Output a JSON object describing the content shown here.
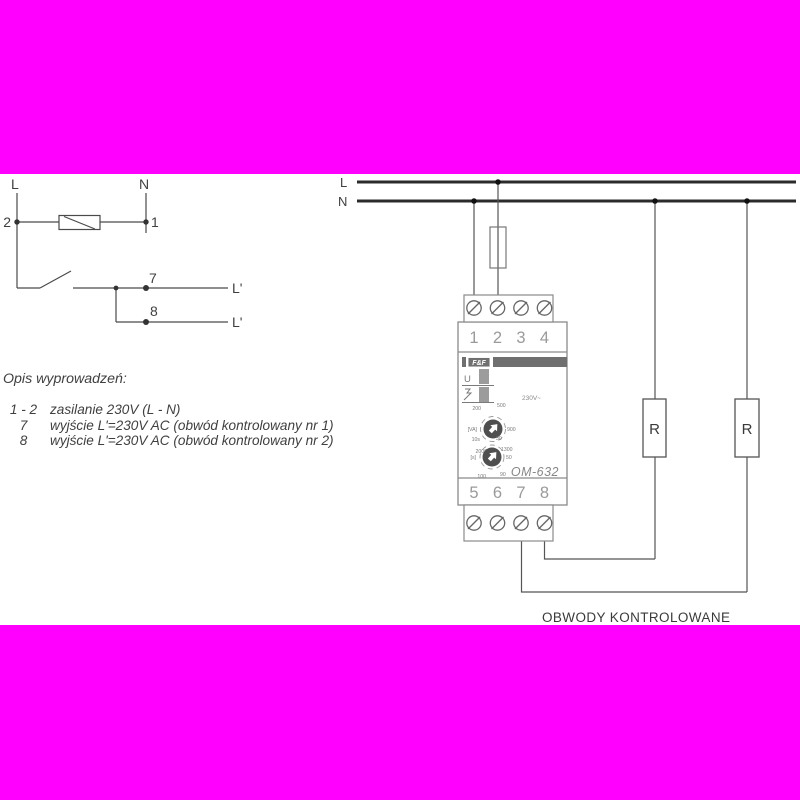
{
  "colors": {
    "background": "#ffffff",
    "masking_band": "#ff00ff",
    "thin_line": "#4a4a4a",
    "thick_line": "#2b2b2b",
    "device_outline": "#8a8a8a",
    "muted_text": "#9a9a9a"
  },
  "left_circuit": {
    "label_l": "L",
    "label_n": "N",
    "terminal_2": "2",
    "terminal_1": "1",
    "terminal_7": "7",
    "terminal_8": "8",
    "out_1": "L'",
    "out_2": "L'"
  },
  "terminal_description": {
    "title": "Opis wyprowadzeń:",
    "rows": [
      {
        "num": "1 - 2",
        "text": "zasilanie 230V (L - N)"
      },
      {
        "num": "7",
        "text": "wyjście L'=230V AC (obwód kontrolowany nr 1)"
      },
      {
        "num": "8",
        "text": "wyjście L'=230V AC (obwód kontrolowany nr 2)"
      }
    ]
  },
  "wiring_diagram": {
    "line_l": "L",
    "line_n": "N",
    "load_1": "R",
    "load_2": "R",
    "caption": "OBWODY KONTROLOWANE"
  },
  "device": {
    "brand": "F&F",
    "model": "OM-632",
    "voltage": "230V~",
    "led_u_label": "U",
    "top_terminals": [
      "1",
      "2",
      "3",
      "4"
    ],
    "bottom_terminals": [
      "5",
      "6",
      "7",
      "8"
    ],
    "knob_power": {
      "unit": "[VA]",
      "ticks": [
        "200",
        "500",
        "900",
        "1300",
        "2000"
      ]
    },
    "knob_time": {
      "unit": "[s]",
      "ticks": [
        "10s",
        "30",
        "50",
        "90",
        "100"
      ]
    }
  }
}
